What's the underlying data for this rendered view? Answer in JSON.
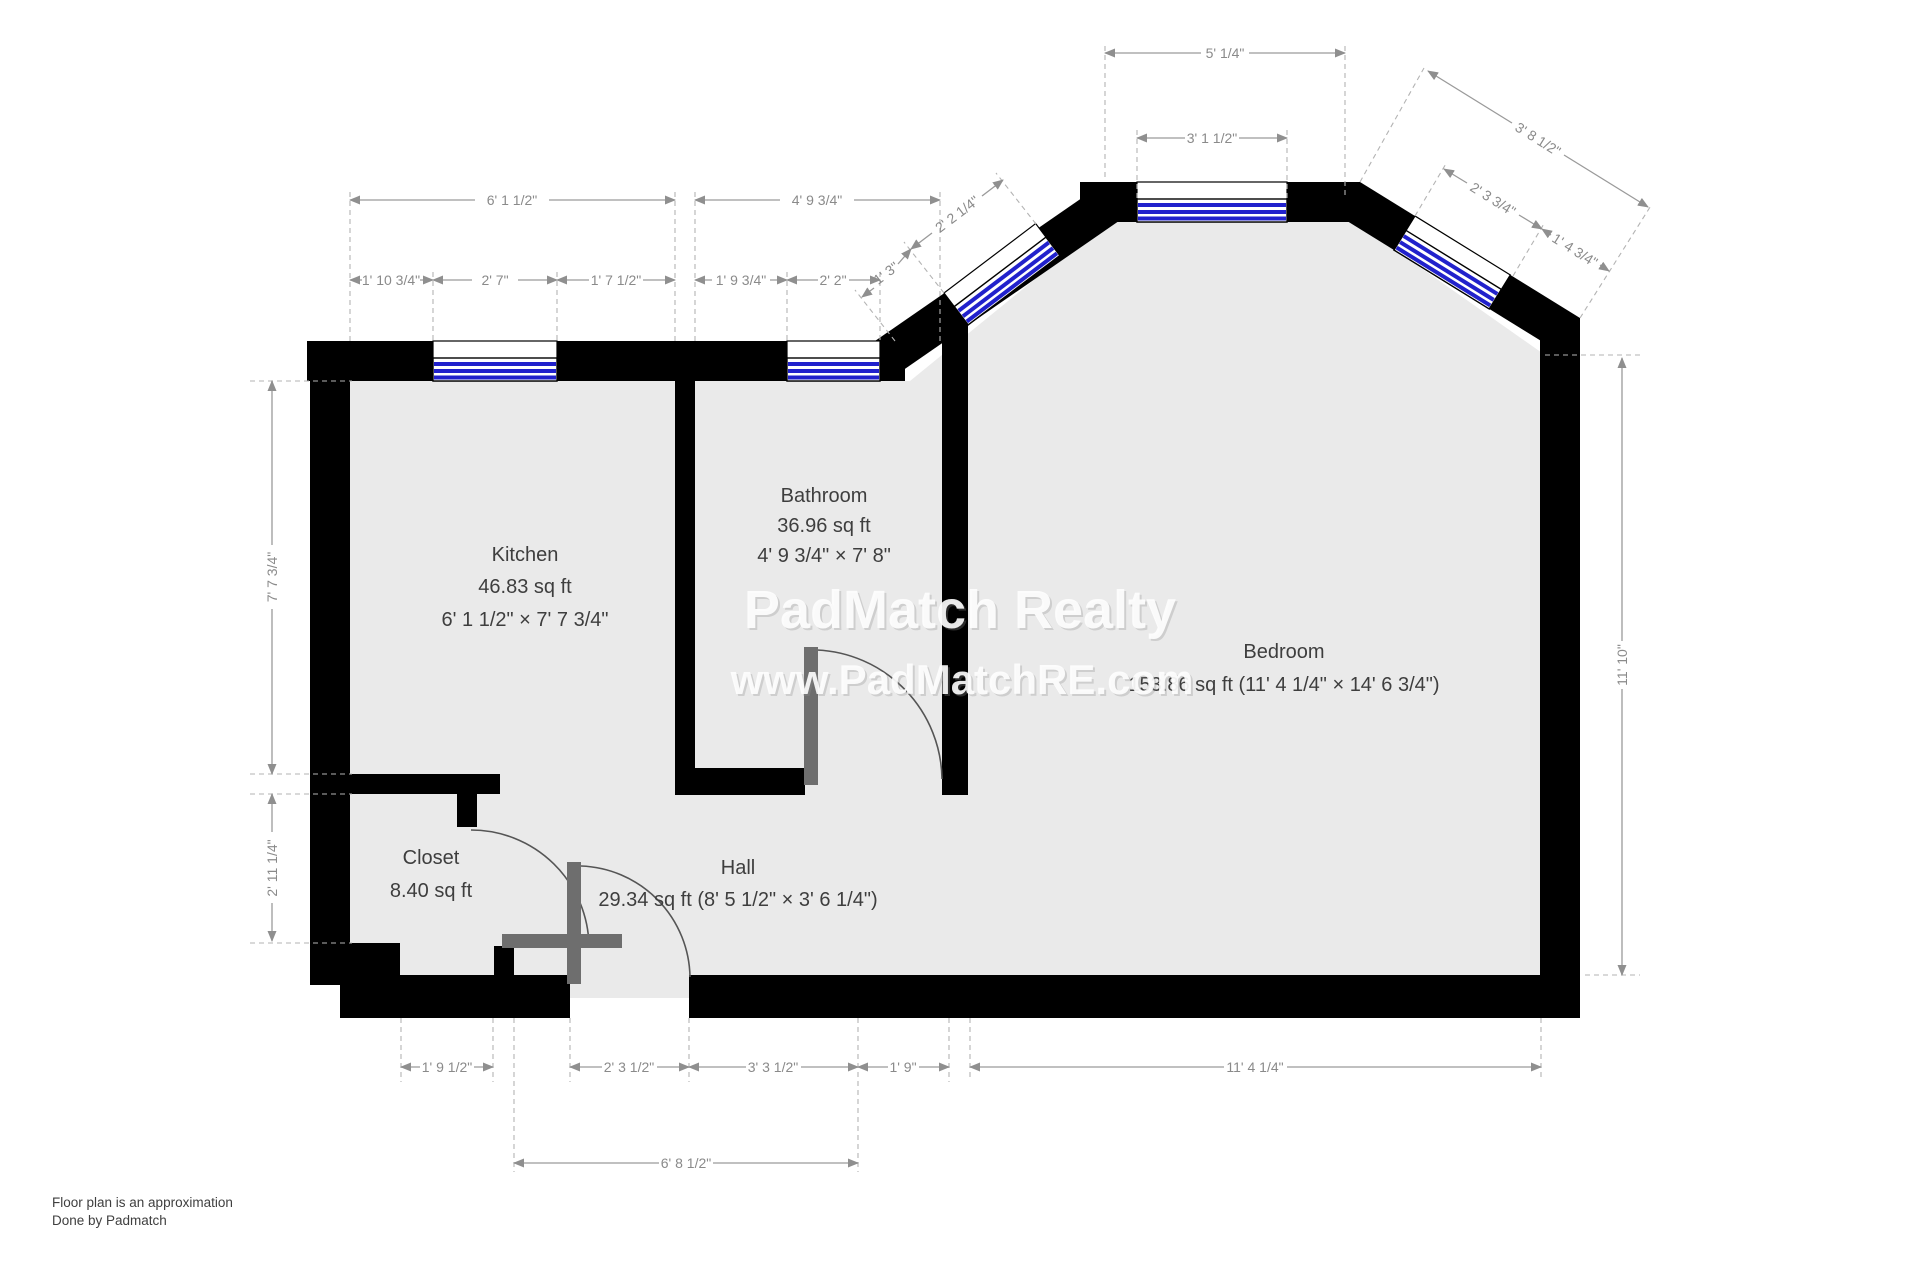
{
  "rooms": {
    "kitchen": {
      "name": "Kitchen",
      "area": "46.83 sq ft",
      "size": "6' 1 1/2\" × 7' 7 3/4\""
    },
    "bathroom": {
      "name": "Bathroom",
      "area": "36.96 sq ft",
      "size": "4' 9 3/4\" × 7' 8\""
    },
    "bedroom": {
      "name": "Bedroom",
      "details": "153.86 sq ft (11' 4 1/4\" × 14' 6 3/4\")"
    },
    "closet": {
      "name": "Closet",
      "area": "8.40 sq ft"
    },
    "hall": {
      "name": "Hall",
      "details": "29.34 sq ft (8' 5 1/2\" × 3' 6 1/4\")"
    }
  },
  "dims": {
    "kitchen_total": "6' 1 1/2\"",
    "kitchen_a": "1' 10 3/4\"",
    "kitchen_b": "2' 7\"",
    "kitchen_c": "1' 7 1/2\"",
    "bath_total": "4' 9 3/4\"",
    "bath_a": "1' 9 3/4\"",
    "bath_b": "2' 2\"",
    "diag_nw_inner": "1' 3\"",
    "diag_nw_outer": "2' 2 1/4\"",
    "bay_total": "5' 1/4\"",
    "bay_window": "3' 1 1/2\"",
    "diag_ne_outer": "3' 8 1/2\"",
    "diag_ne_a": "2' 3 3/4\"",
    "diag_ne_b": "1' 4 3/4\"",
    "left_kitchen": "7' 7 3/4\"",
    "left_closet": "2' 11 1/4\"",
    "right_bedroom": "11' 10\"",
    "bottom_a": "1' 9 1/2\"",
    "bottom_b": "2' 3 1/2\"",
    "bottom_c": "3' 3 1/2\"",
    "bottom_d": "1' 9\"",
    "bottom_bedroom": "11' 4 1/4\"",
    "bottom_hall": "6' 8 1/2\""
  },
  "watermark": {
    "line1": "PadMatch Realty",
    "line2": "www.PadMatchRE.com"
  },
  "footer": {
    "line1": "Floor plan is an approximation",
    "line2": "Done by Padmatch"
  },
  "colors": {
    "wall": "#000000",
    "floor": "#eaeaea",
    "window_blue": "#2121cc",
    "dimension_gray": "#8a8a8a",
    "door_gray": "#6e6e6e",
    "watermark": "#ffffff"
  }
}
